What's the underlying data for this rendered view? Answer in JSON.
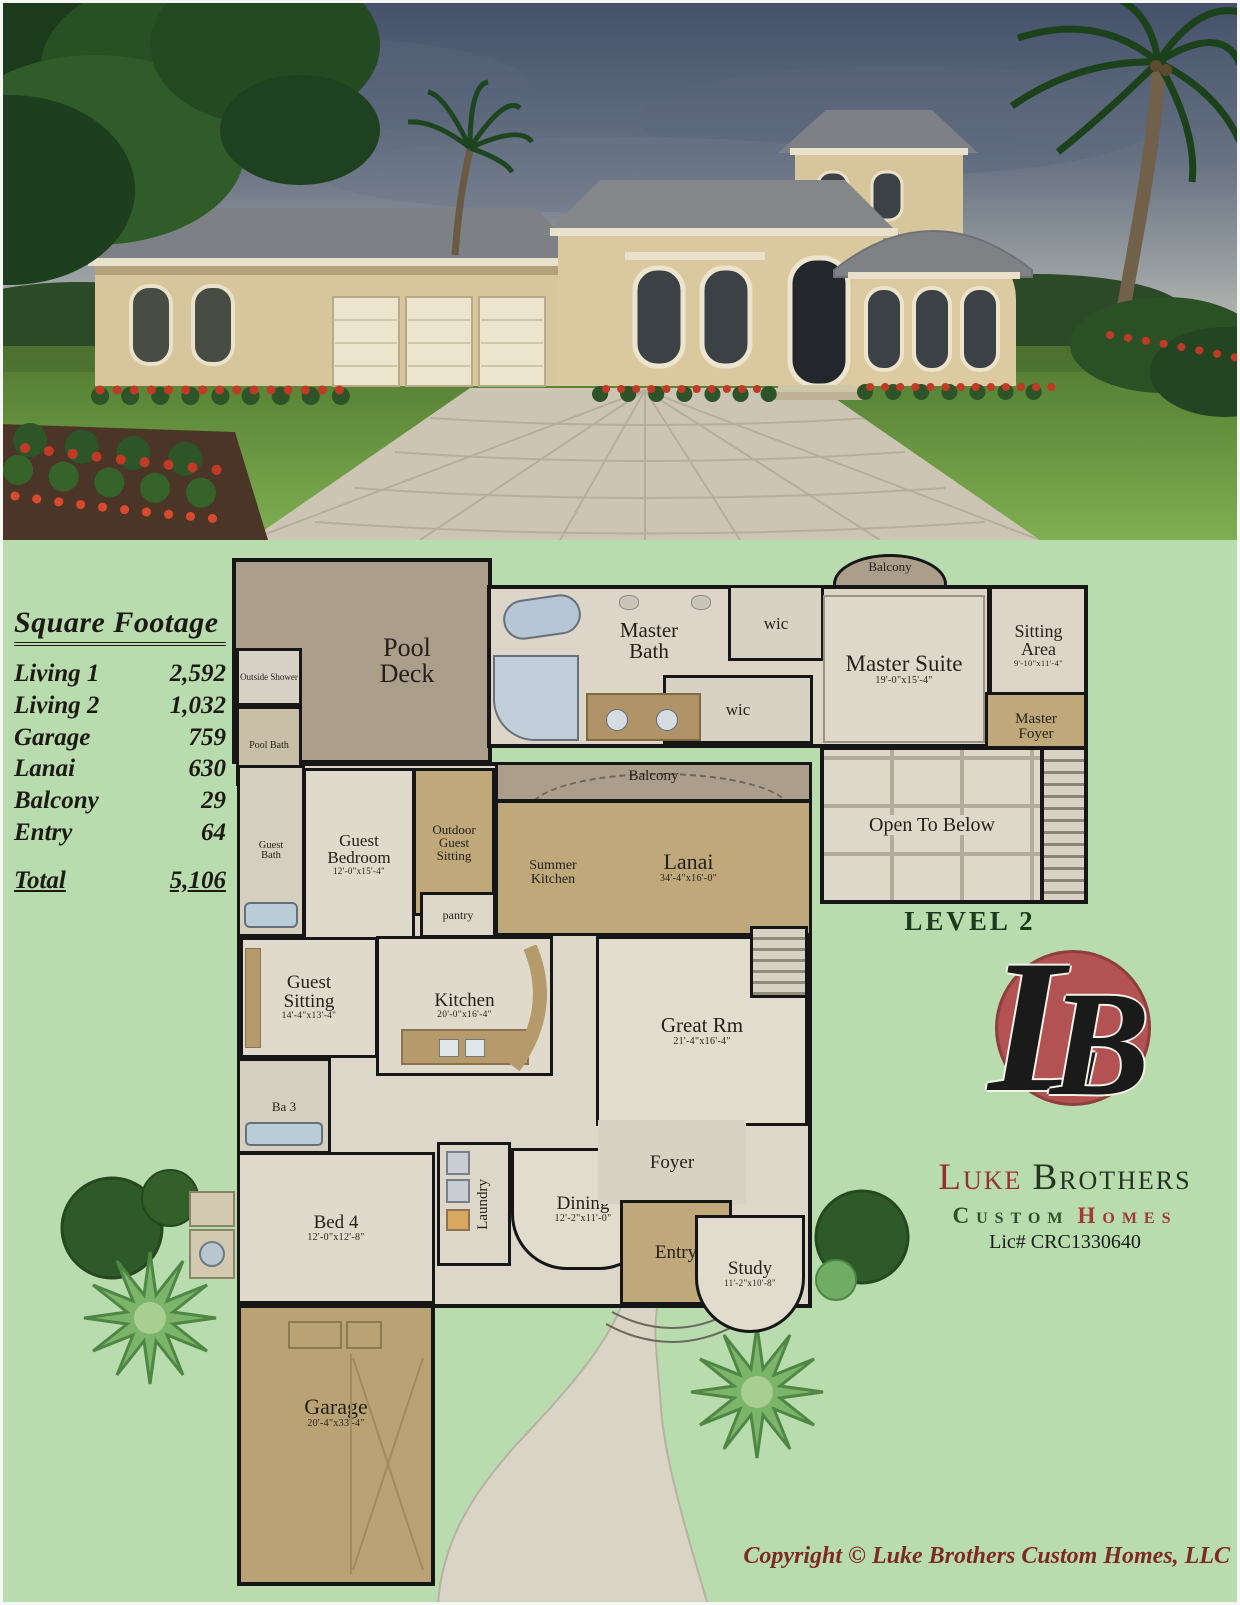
{
  "colors": {
    "page_bg": "#b9dcae",
    "wall": "#161616",
    "floor_light": "#e0dacc",
    "tile": "#d8d2c4",
    "deck_gray": "#ab9f8b",
    "tan_room": "#bfa87a",
    "logo_red": "#b25252",
    "brand_red": "#953131",
    "brand_green": "#2d4f2d",
    "copyright_red": "#7d2a24"
  },
  "sqft_table": {
    "title": "Square Footage",
    "rows": [
      {
        "label": "Living 1",
        "value": "2,592"
      },
      {
        "label": "Living 2",
        "value": "1,032"
      },
      {
        "label": "Garage",
        "value": "759"
      },
      {
        "label": "Lanai",
        "value": "630"
      },
      {
        "label": "Balcony",
        "value": "29"
      },
      {
        "label": "Entry",
        "value": "64"
      }
    ],
    "total": {
      "label": "Total",
      "value": "5,106"
    }
  },
  "level1": {
    "rooms": {
      "pool_deck": {
        "label": "Pool Deck"
      },
      "outside_shower": {
        "label": "Outside Shower"
      },
      "pool_bath": {
        "label": "Pool Bath"
      },
      "balcony": {
        "label": "Balcony"
      },
      "guest_bath": {
        "label": "Guest Bath"
      },
      "guest_bedroom": {
        "label": "Guest Bedroom",
        "dims": "12'-0\"x15'-4\""
      },
      "outdoor_guest_sitting": {
        "label": "Outdoor Guest Sitting"
      },
      "summer_kitchen": {
        "label": "Summer Kitchen"
      },
      "lanai": {
        "label": "Lanai",
        "dims": "34'-4\"x16'-0\""
      },
      "pantry": {
        "label": "pantry"
      },
      "guest_sitting": {
        "label": "Guest Sitting",
        "dims": "14'-4\"x13'-4\""
      },
      "kitchen": {
        "label": "Kitchen",
        "dims": "20'-0\"x16'-4\""
      },
      "great_rm": {
        "label": "Great Rm",
        "dims": "21'-4\"x16'-4\""
      },
      "ba_3": {
        "label": "Ba 3"
      },
      "bed_4": {
        "label": "Bed 4",
        "dims": "12'-0\"x12'-8\""
      },
      "laundry": {
        "label": "Laundry"
      },
      "dining": {
        "label": "Dining",
        "dims": "12'-2\"x11'-0\""
      },
      "foyer": {
        "label": "Foyer"
      },
      "entry": {
        "label": "Entry"
      },
      "study": {
        "label": "Study",
        "dims": "11'-2\"x10'-8\""
      },
      "garage": {
        "label": "Garage",
        "dims": "20'-4\"x33'-4\""
      }
    }
  },
  "level2": {
    "caption": "LEVEL 2",
    "rooms": {
      "balcony": {
        "label": "Balcony"
      },
      "master_bath": {
        "label": "Master Bath"
      },
      "wic_1": {
        "label": "wic"
      },
      "wic_2": {
        "label": "wic"
      },
      "master_suite": {
        "label": "Master Suite",
        "dims": "19'-0\"x15'-4\""
      },
      "sitting_area": {
        "label": "Sitting Area",
        "dims": "9'-10\"x11'-4\""
      },
      "master_foyer": {
        "label": "Master Foyer"
      },
      "open_to_below": {
        "label": "Open To Below"
      }
    }
  },
  "logo": {
    "monogram_l": "L",
    "monogram_b": "B",
    "name_first": "Luke",
    "name_second": "Brothers",
    "subtitle_first": "Custom",
    "subtitle_second": "Homes",
    "license": "Lic# CRC1330640"
  },
  "footer": {
    "copyright": "Copyright © Luke Brothers Custom Homes, LLC"
  }
}
